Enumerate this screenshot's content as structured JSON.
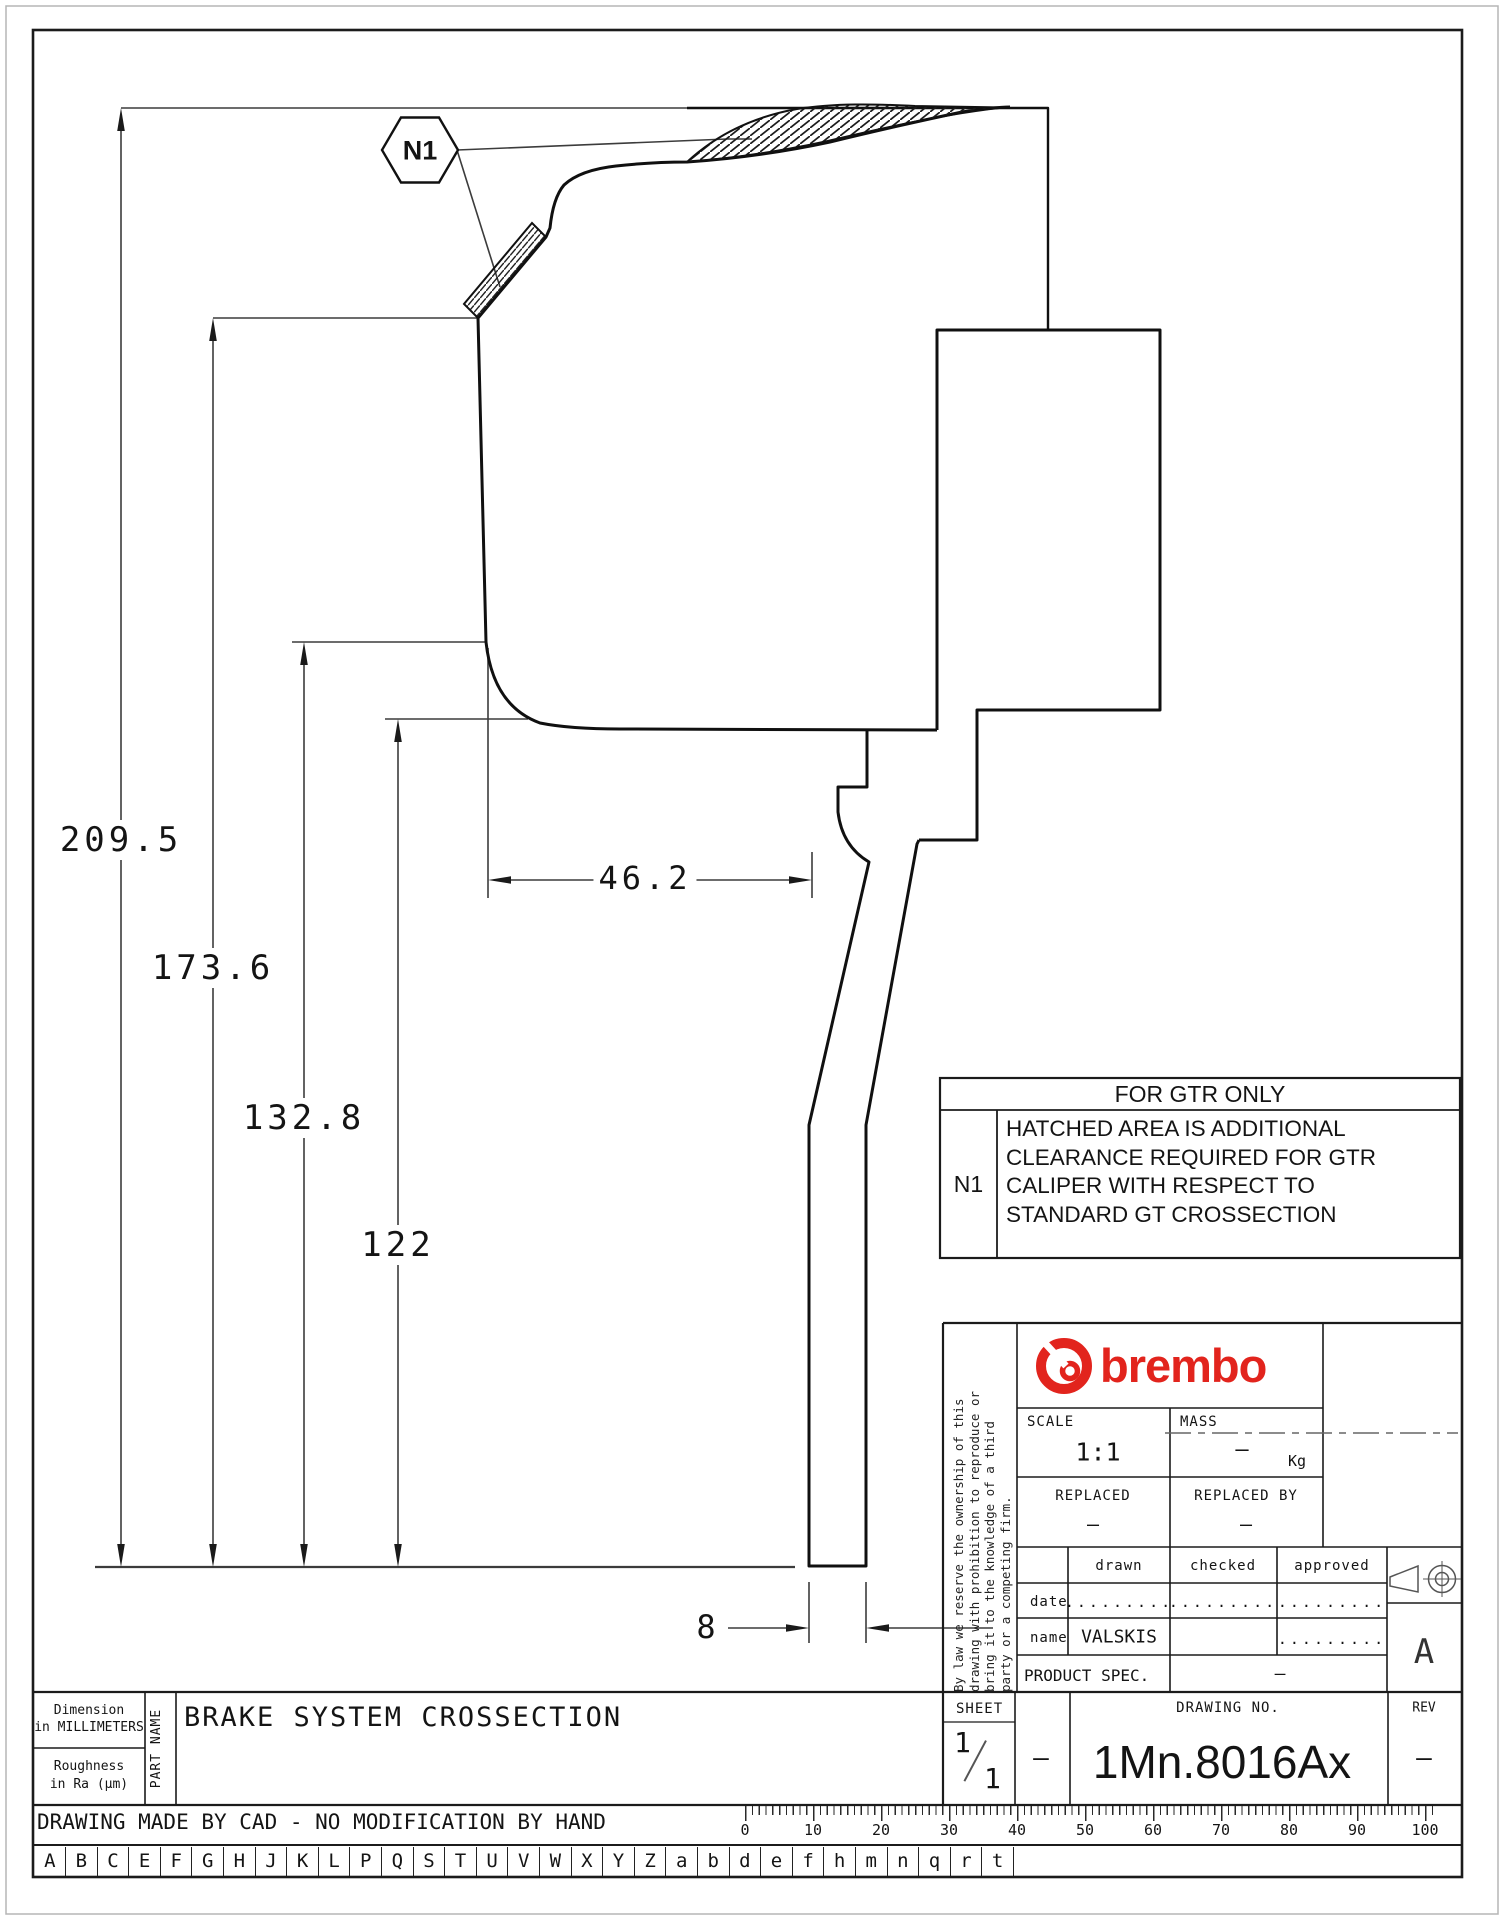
{
  "figure": {
    "dim_height_outer": "209.5",
    "dim_height_mid": "173.6",
    "dim_height_lower": "132.8",
    "dim_height_base": "122",
    "dim_width": "46.2",
    "dim_leg": "8",
    "callout_tag": "N1"
  },
  "note_box": {
    "header": "FOR GTR ONLY",
    "tag": "N1",
    "line1": "HATCHED AREA IS ADDITIONAL",
    "line2": "CLEARANCE REQUIRED FOR GTR",
    "line3": "CALIPER WITH RESPECT TO",
    "line4": "STANDARD GT CROSSECTION"
  },
  "title_block": {
    "brand": "brembo",
    "scale_label": "SCALE",
    "scale_value": "1:1",
    "mass_label": "MASS",
    "mass_value": "–",
    "mass_unit": "Kg",
    "replaced_label": "REPLACED",
    "replaced_value": "–",
    "replaced_by_label": "REPLACED BY",
    "replaced_by_value": "–",
    "col_drawn": "drawn",
    "col_checked": "checked",
    "col_approved": "approved",
    "row_date": "date",
    "row_name": "name",
    "date_drawn_dots": ".........",
    "date_checked_dots": ".........",
    "date_approved_dots": ".........",
    "name_value": "VALSKIS",
    "name_approved_dots": ".........",
    "product_label": "PRODUCT SPEC.",
    "product_value": "–",
    "format_letter": "A",
    "legal1": "By law we reserve the ownership of this",
    "legal2": "drawing with prohibition to reproduce or",
    "legal3": "bring it to the knowledge of a third",
    "legal4": "party or a competing firm.",
    "sheet_label": "SHEET",
    "sheet_num": "1",
    "sheet_den": "1",
    "sheet_dash": "–",
    "dwg_label": "DRAWING NO.",
    "dwg_value": "1Mn.8016Ax",
    "rev_label": "REV",
    "rev_value": "–"
  },
  "footer": {
    "dim1": "Dimension",
    "dim2": "in MILLIMETERS",
    "rough1": "Roughness",
    "rough2": "in Ra (µm)",
    "part_label": "PART NAME",
    "title": "BRAKE SYSTEM CROSSECTION",
    "cad_note": "DRAWING MADE BY CAD - NO MODIFICATION BY HAND",
    "ruler": [
      "0",
      "10",
      "20",
      "30",
      "40",
      "50",
      "60",
      "70",
      "80",
      "90",
      "100"
    ],
    "letters": [
      "A",
      "B",
      "C",
      "E",
      "F",
      "G",
      "H",
      "J",
      "K",
      "L",
      "P",
      "Q",
      "S",
      "T",
      "U",
      "V",
      "W",
      "X",
      "Y",
      "Z",
      "a",
      "b",
      "d",
      "e",
      "f",
      "h",
      "m",
      "n",
      "q",
      "r",
      "t"
    ]
  },
  "colors": {
    "brand_red": "#e2241d",
    "ink": "#141414"
  }
}
